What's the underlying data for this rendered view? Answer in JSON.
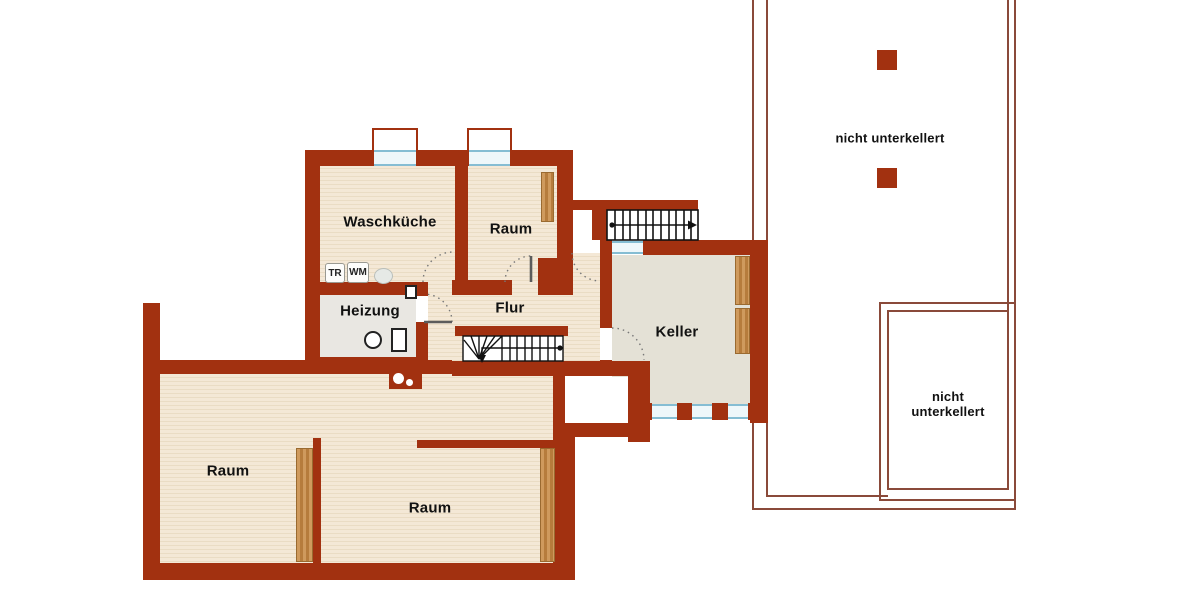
{
  "floorplan": {
    "rooms": [
      {
        "id": "waschkueche",
        "label": "Waschküche"
      },
      {
        "id": "raum-top",
        "label": "Raum"
      },
      {
        "id": "heizung",
        "label": "Heizung"
      },
      {
        "id": "flur",
        "label": "Flur"
      },
      {
        "id": "keller",
        "label": "Keller"
      },
      {
        "id": "raum-left",
        "label": "Raum"
      },
      {
        "id": "raum-bottom",
        "label": "Raum"
      }
    ],
    "annotations": [
      {
        "id": "not-basement-top",
        "label": "nicht unterkellert"
      },
      {
        "id": "not-basement-bottom",
        "label": "nicht unterkellert"
      }
    ],
    "appliances": [
      {
        "id": "dryer",
        "label": "TR"
      },
      {
        "id": "washer",
        "label": "WM"
      }
    ],
    "colors": {
      "wall": "#a23110",
      "floor_wood": "#f4e8d6",
      "floor_wood_grain": "#eadcc4",
      "floor_keller": "#e4e1d6",
      "floor_heizung": "#e9e7e2",
      "glass_frame": "#85bdd3",
      "glass_fill": "#eef7fa",
      "outline_thin": "#8a4a3a",
      "stair_ink": "#111111",
      "door_arc": "#777777"
    }
  }
}
